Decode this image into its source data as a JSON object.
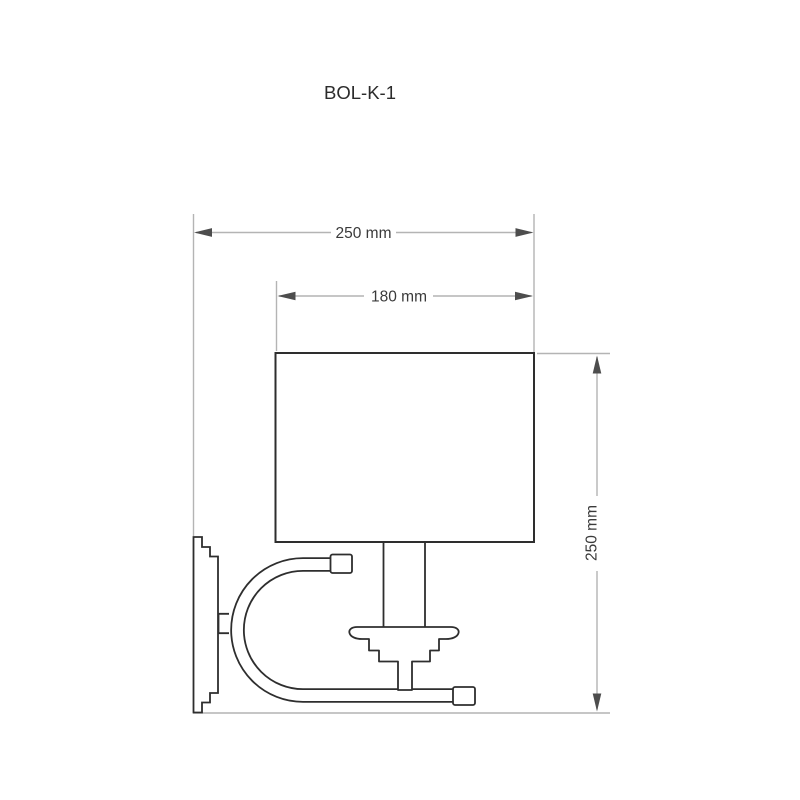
{
  "product": {
    "code": "BOL-K-1"
  },
  "dimensions": {
    "overall_width": {
      "label": "250 mm",
      "value": 250,
      "unit": "mm",
      "orientation": "horizontal"
    },
    "shade_width": {
      "label": "180 mm",
      "value": 180,
      "unit": "mm",
      "orientation": "horizontal"
    },
    "overall_height": {
      "label": "250 mm",
      "value": 250,
      "unit": "mm",
      "orientation": "vertical"
    }
  },
  "colors": {
    "background": "#ffffff",
    "outline": "#2e2e2e",
    "dimension_line": "#b4b4b4",
    "arrow": "#4d4d4d",
    "text": "#3a3a3a"
  }
}
